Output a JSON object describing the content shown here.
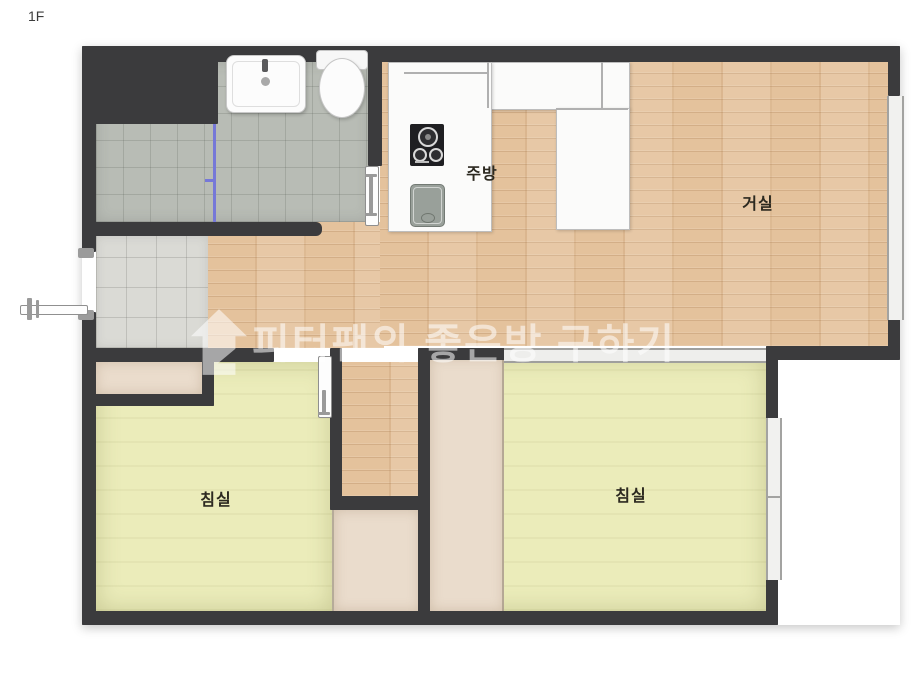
{
  "floor": {
    "label": "1F"
  },
  "watermark": {
    "text": "피터팬의 좋은방 구하기",
    "icon": "house-icon",
    "color": "rgba(255,255,255,0.55)"
  },
  "rooms": {
    "kitchen": {
      "label": "주방"
    },
    "living": {
      "label": "거실"
    },
    "bedroom_left": {
      "label": "침실"
    },
    "bedroom_right": {
      "label": "침실"
    }
  },
  "fixtures": {
    "bathroom_sink": "sink-icon",
    "toilet": "toilet-icon",
    "cooktop": "stove-icon",
    "kitchen_sink": "kitchen-sink-icon",
    "shower_partition": "glass-partition",
    "entrance_door": "door-icon",
    "bathroom_door": "door-icon",
    "bedroom_door": "door-icon"
  },
  "colors": {
    "wall": "#3b3b3d",
    "wood_floor": "#e4c29c",
    "bedroom_floor": "#ebecba",
    "bathroom_tile": "#b8bcb5",
    "entrance_tile": "#dadad5",
    "closet": "#eadccc",
    "counter": "#fbfbfa",
    "shower_partition": "#7678d8",
    "window": "#f1f1ef",
    "label_text": "#2c2920"
  }
}
